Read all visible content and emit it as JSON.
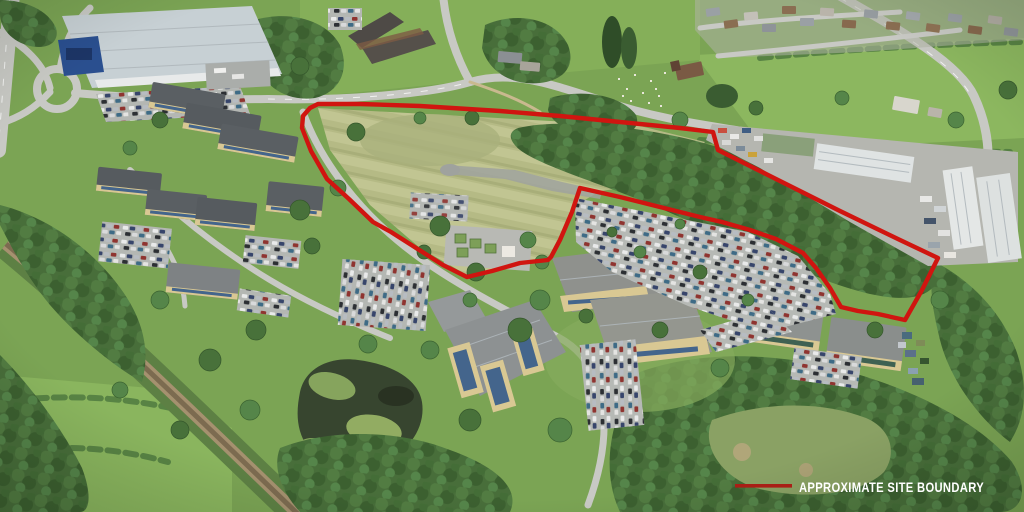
{
  "image": {
    "type": "aerial-photograph",
    "subject": "Business park and greenfield development site seen from the air, with offices, car parks, a pond, a railway line, woodland and an annotated site boundary"
  },
  "legend": {
    "label": "APPROXIMATE SITE BOUNDARY",
    "swatch_color": "#a91f16",
    "text_color": "#ffffff"
  },
  "boundary": {
    "color": "#d01510",
    "stroke_width": 4.4,
    "points": "318,104 360,104 420,106 500,111 560,116 620,122 680,128 713,132 718,150 780,181 840,211 900,240 938,258 922,290 905,320 878,314 858,311 841,307 830,288 816,268 803,253 776,239 750,230 722,222 700,217 660,207 620,197 580,188 572,212 560,240 551,257 548,260 520,263 492,271 467,277 443,265 413,246 391,232 373,222 349,199 327,179 311,151 302,128 303,116 310,108"
  },
  "palette": {
    "grass": "#7ba454",
    "meadow": "#b5ba85",
    "woodland": "#486e3a",
    "road": "#c8c9c4",
    "water": "#37452f",
    "boundary_red": "#d01510"
  }
}
